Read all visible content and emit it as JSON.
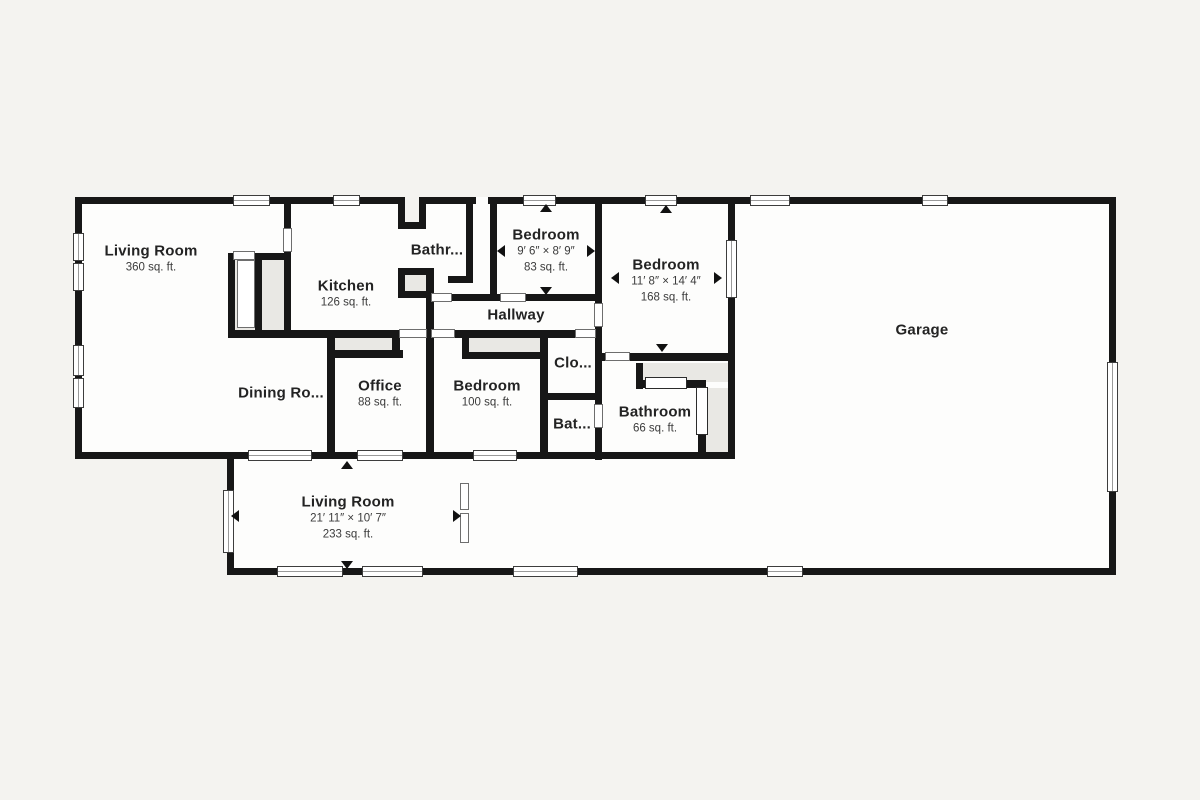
{
  "floorplan": {
    "title": "House floor plan",
    "colors": {
      "wall": "#171717",
      "room": "#fdfdfc",
      "background": "#f4f3f0",
      "closet": "#e9e8e4",
      "text": "#232323"
    },
    "rooms": {
      "living_room_main": {
        "name": "Living Room",
        "area": "360 sq. ft."
      },
      "kitchen": {
        "name": "Kitchen",
        "area": "126 sq. ft."
      },
      "bathroom_top": {
        "name": "Bathr..."
      },
      "bedroom_small": {
        "name": "Bedroom",
        "dims": "9′ 6″ × 8′ 9″",
        "area": "83 sq. ft."
      },
      "bedroom_large": {
        "name": "Bedroom",
        "dims": "11′ 8″ × 14′ 4″",
        "area": "168 sq. ft."
      },
      "garage": {
        "name": "Garage"
      },
      "hallway": {
        "name": "Hallway"
      },
      "dining_room": {
        "name": "Dining Ro..."
      },
      "office": {
        "name": "Office",
        "area": "88 sq. ft."
      },
      "bedroom_middle": {
        "name": "Bedroom",
        "area": "100 sq. ft."
      },
      "closet": {
        "name": "Clo..."
      },
      "bathroom_hall": {
        "name": "Bat..."
      },
      "bathroom_main": {
        "name": "Bathroom",
        "area": "66 sq. ft."
      },
      "living_room_lower": {
        "name": "Living Room",
        "dims": "21′ 11″ × 10′ 7″",
        "area": "233 sq. ft."
      }
    }
  }
}
